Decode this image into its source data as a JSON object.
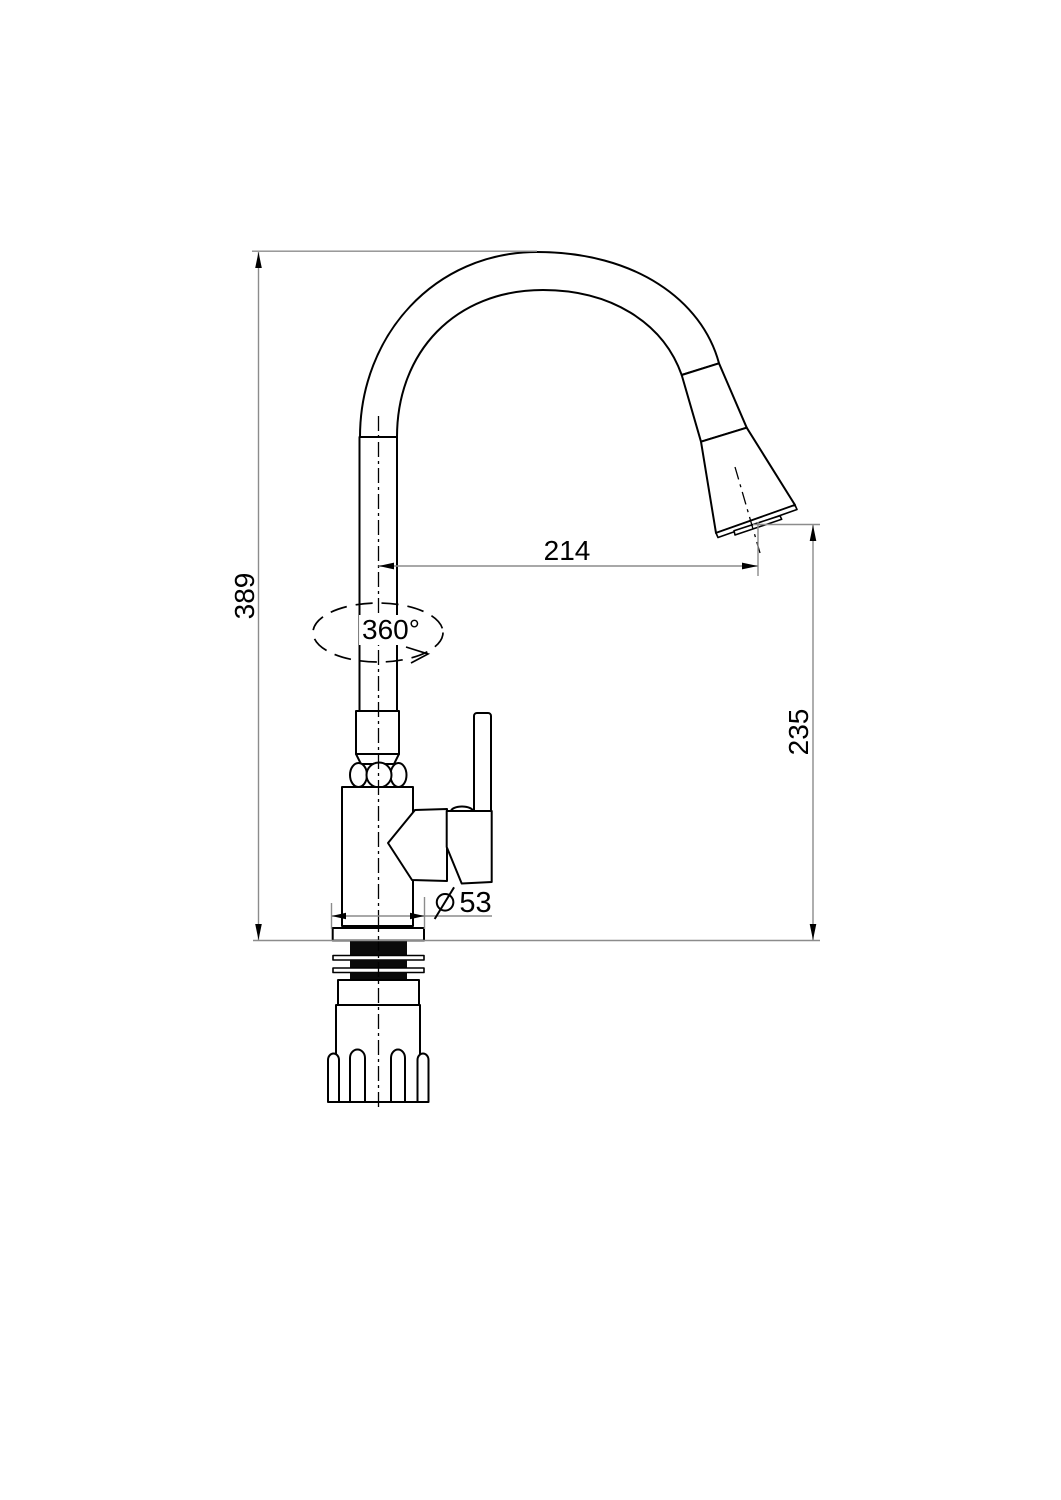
{
  "drawing": {
    "subject": "pull-down kitchen faucet technical drawing",
    "labels": {
      "overall_height": "389",
      "spout_reach": "214",
      "outlet_height": "235",
      "swivel_angle": "360°",
      "base_diameter_value": "53"
    },
    "icons": {
      "diameter_symbol": "circle-with-diagonal-slash"
    },
    "colors": {
      "outline": "#000000",
      "dimension_lines": "#8c8c8c",
      "fill_solid": "#0a0a0a",
      "background": "#ffffff"
    }
  }
}
